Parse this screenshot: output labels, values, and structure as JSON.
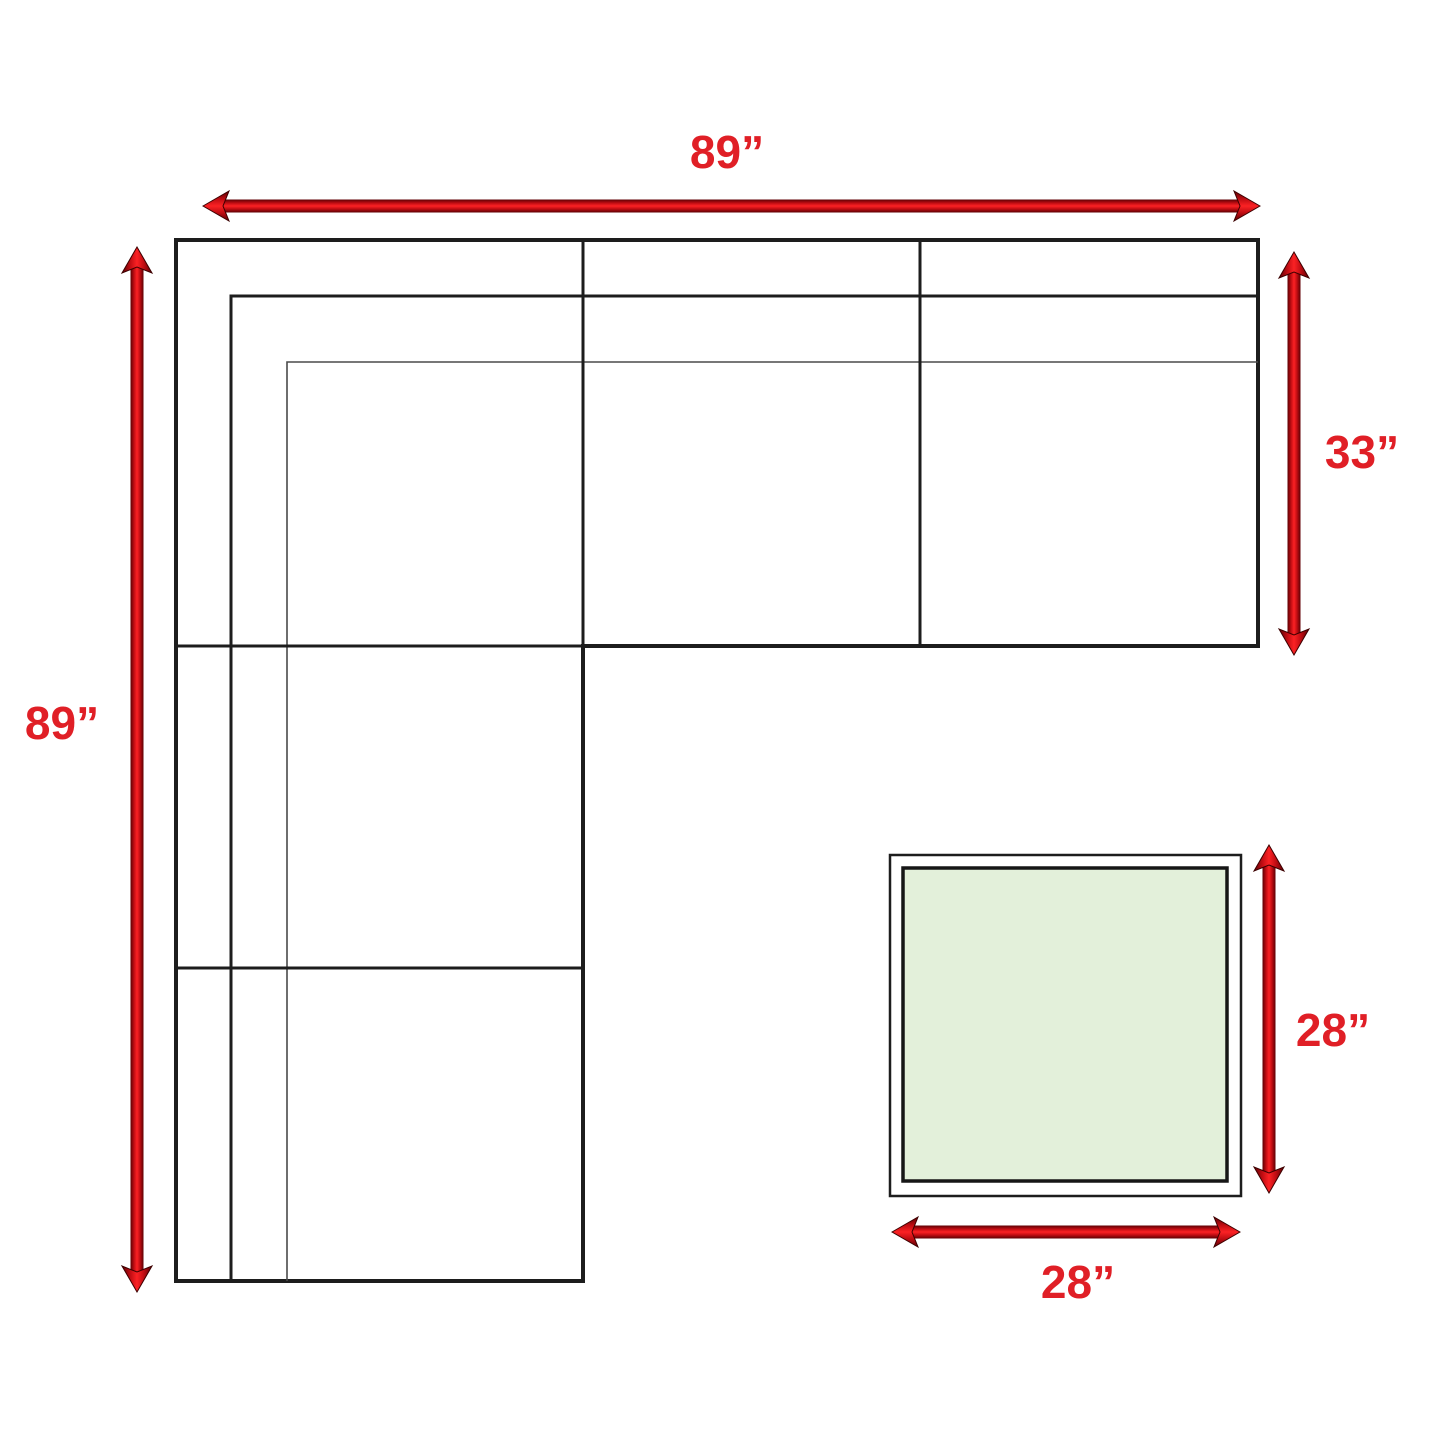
{
  "diagram": {
    "title": "sectional-sofa-and-ottoman-dimension-diagram",
    "sofa": {
      "width_label": "89”",
      "height_label": "89”",
      "depth_label": "33”"
    },
    "ottoman": {
      "side_label": "28”",
      "bottom_label": "28”"
    },
    "colors": {
      "arrow_red": "#e01f26",
      "outline_black": "#1d1d1d",
      "thin_line": "#4a4a4a",
      "ottoman_fill": "#e3f0da",
      "background": "#ffffff"
    }
  }
}
